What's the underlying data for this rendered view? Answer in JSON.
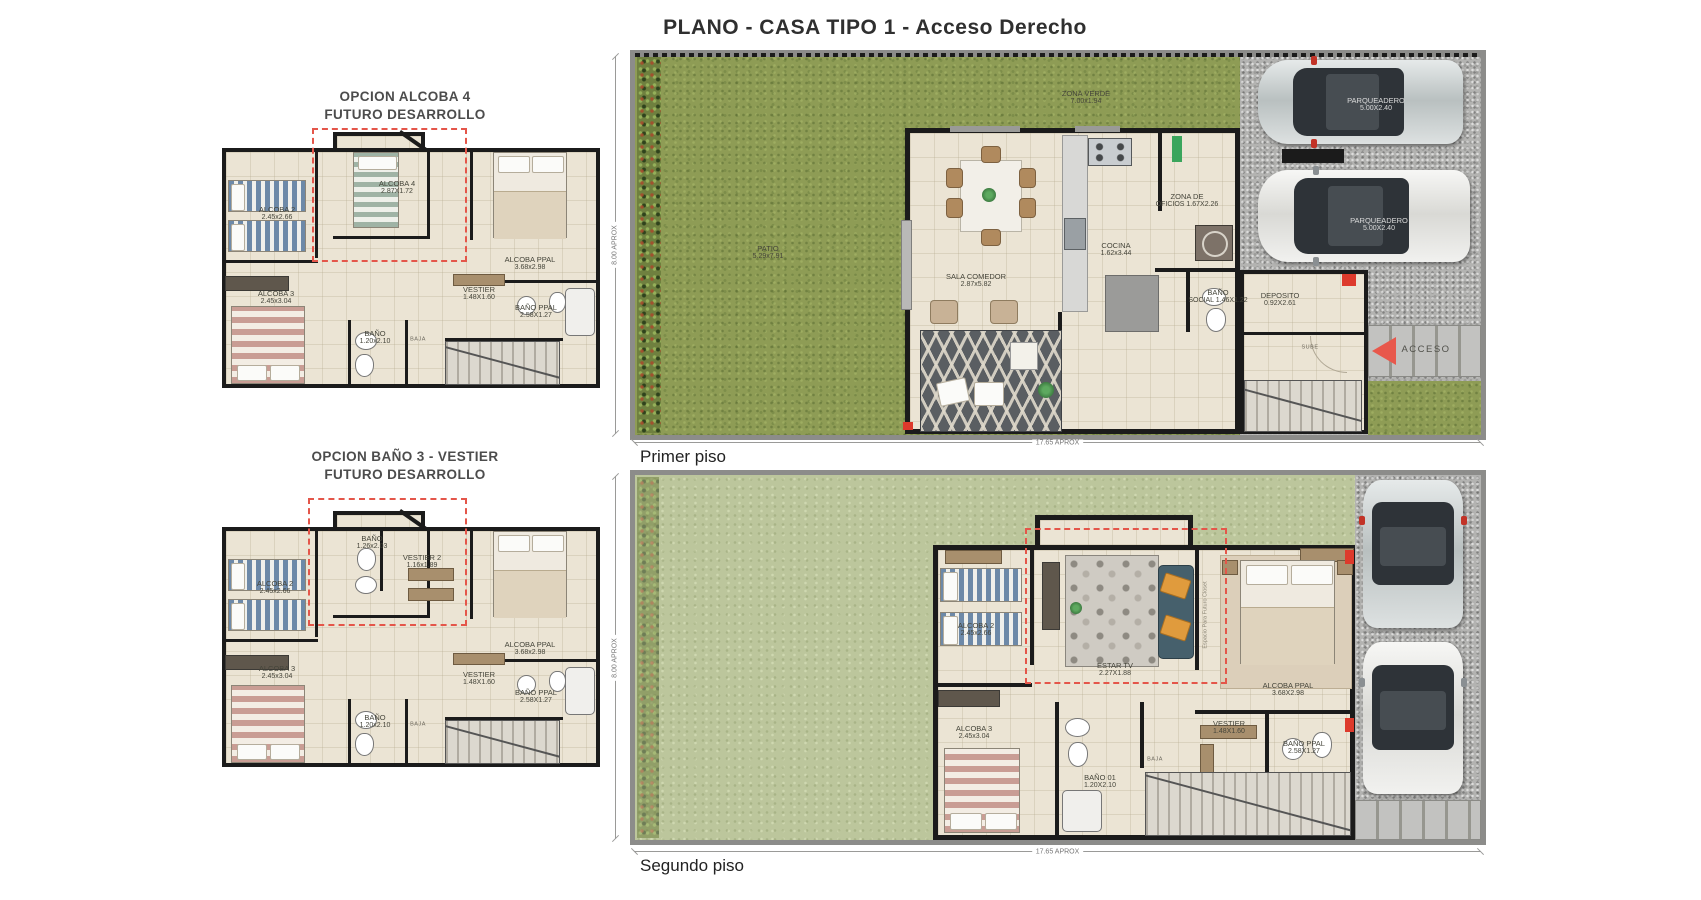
{
  "page": {
    "title": "PLANO - CASA TIPO  1 - Acceso Derecho"
  },
  "colors": {
    "grass_dark": "#8e9c55",
    "grass_light": "#bcc69c",
    "floor": "#ebe4d4",
    "wall": "#1b1b1b",
    "gravel": "#b3b3b1",
    "red_accent": "#dd3a2c",
    "dashed_red": "#e4564a",
    "sofa_teal": "#46606c",
    "pillow_orange": "#e09b3d"
  },
  "plans": {
    "opcion_alcoba": {
      "title_line1": "OPCION ALCOBA 4",
      "title_line2": "FUTURO DESARROLLO",
      "labels": [
        {
          "t": "ALCOBA  2",
          "d": "2.45x2.66",
          "x": 72,
          "y": 126
        },
        {
          "t": "ALCOBA  4",
          "d": "2.87X1.72",
          "x": 192,
          "y": 100
        },
        {
          "t": "ALCOBA PPAL",
          "d": "3.68x2.98",
          "x": 325,
          "y": 176
        },
        {
          "t": "ALCOBA  3",
          "d": "2.45x3.04",
          "x": 71,
          "y": 210
        },
        {
          "t": "VESTIER",
          "d": "1.48X1.60",
          "x": 274,
          "y": 206
        },
        {
          "t": "BAÑO PPAL",
          "d": "2.58X1.27",
          "x": 331,
          "y": 224
        },
        {
          "t": "BAÑO",
          "d": "1.20x2.10",
          "x": 170,
          "y": 250
        },
        {
          "t": "BAJA",
          "x": 213,
          "y": 252,
          "cls": "t-tiny"
        }
      ]
    },
    "opcion_bano": {
      "title_line1": "OPCION BAÑO 3 - VESTIER",
      "title_line2": "FUTURO DESARROLLO",
      "labels": [
        {
          "t": "BAÑO",
          "d": "1.26x2.03",
          "x": 167,
          "y": 95
        },
        {
          "t": "VESTIER  2",
          "d": "1.16x1.89",
          "x": 217,
          "y": 114
        },
        {
          "t": "ALCOBA  2",
          "d": "2.45x2.66",
          "x": 70,
          "y": 140
        },
        {
          "t": "ALCOBA PPAL",
          "d": "3.68x2.98",
          "x": 325,
          "y": 201
        },
        {
          "t": "ALCOBA  3",
          "d": "2.45x3.04",
          "x": 72,
          "y": 225
        },
        {
          "t": "VESTIER",
          "d": "1.48X1.60",
          "x": 274,
          "y": 231
        },
        {
          "t": "BAÑO PPAL",
          "d": "2.58X1.27",
          "x": 331,
          "y": 249
        },
        {
          "t": "BAÑO",
          "d": "1.20x2.10",
          "x": 170,
          "y": 274
        },
        {
          "t": "BAJA",
          "x": 213,
          "y": 277,
          "cls": "t-tiny"
        }
      ]
    },
    "primer": {
      "caption": "Primer piso",
      "dim_left": "8.00 APROX",
      "dim_bottom": "17.65 APROX",
      "labels": [
        {
          "t": "ZONA VERDE",
          "d": "7.00x1.94",
          "x": 476,
          "y": 48
        },
        {
          "t": "PATIO",
          "d": "5.29x7.91",
          "x": 158,
          "y": 203
        },
        {
          "t": "SALA COMEDOR",
          "d": "2.87x5.82",
          "x": 366,
          "y": 231
        },
        {
          "t": "COCINA",
          "d": "1.62x3.44",
          "x": 506,
          "y": 200
        },
        {
          "t": "ZONA DE",
          "d": "OFICIOS 1.67X2.26",
          "x": 577,
          "y": 151
        },
        {
          "t": "BAÑO",
          "d": "SOCIAL 1.46X1.22",
          "x": 608,
          "y": 247
        },
        {
          "t": "DEPOSITO",
          "d": "0.92X2.61",
          "x": 670,
          "y": 250
        },
        {
          "t": "PARQUEADERO",
          "d": "5.00X2.40",
          "x": 766,
          "y": 55,
          "cls": "t-roof"
        },
        {
          "t": "PARQUEADERO",
          "d": "5.00X2.40",
          "x": 769,
          "y": 175,
          "cls": "t-roof"
        },
        {
          "t": "ACCESO",
          "x": 816,
          "y": 300,
          "cls": "t-acceso"
        },
        {
          "t": "SUBE",
          "x": 700,
          "y": 298,
          "cls": "t-tiny"
        }
      ]
    },
    "segundo": {
      "caption": "Segundo piso",
      "dim_left": "8.00 APROX",
      "dim_bottom": "17.65 APROX",
      "labels": [
        {
          "t": "ALCOBA 2",
          "d": "2.45x2.66",
          "x": 366,
          "y": 160
        },
        {
          "t": "ESTAR TV",
          "d": "2.27X1.88",
          "x": 505,
          "y": 200
        },
        {
          "t": "ALCOBA PPAL",
          "d": "3.68X2.98",
          "x": 678,
          "y": 220
        },
        {
          "t": "ALCOBA  3",
          "d": "2.45x3.04",
          "x": 364,
          "y": 263
        },
        {
          "t": "BAÑO 01",
          "d": "1.20X2.10",
          "x": 490,
          "y": 312
        },
        {
          "t": "VESTIER",
          "d": "1.48X1.60",
          "x": 619,
          "y": 258
        },
        {
          "t": "BAÑO PPAL",
          "d": "2.58X1.27",
          "x": 694,
          "y": 278
        },
        {
          "t": "BAJA",
          "x": 545,
          "y": 290,
          "cls": "t-tiny"
        },
        {
          "t": "Espacio Para Futuro Closet",
          "x": 596,
          "y": 145,
          "cls": "t-note",
          "rot": 90
        }
      ]
    }
  }
}
